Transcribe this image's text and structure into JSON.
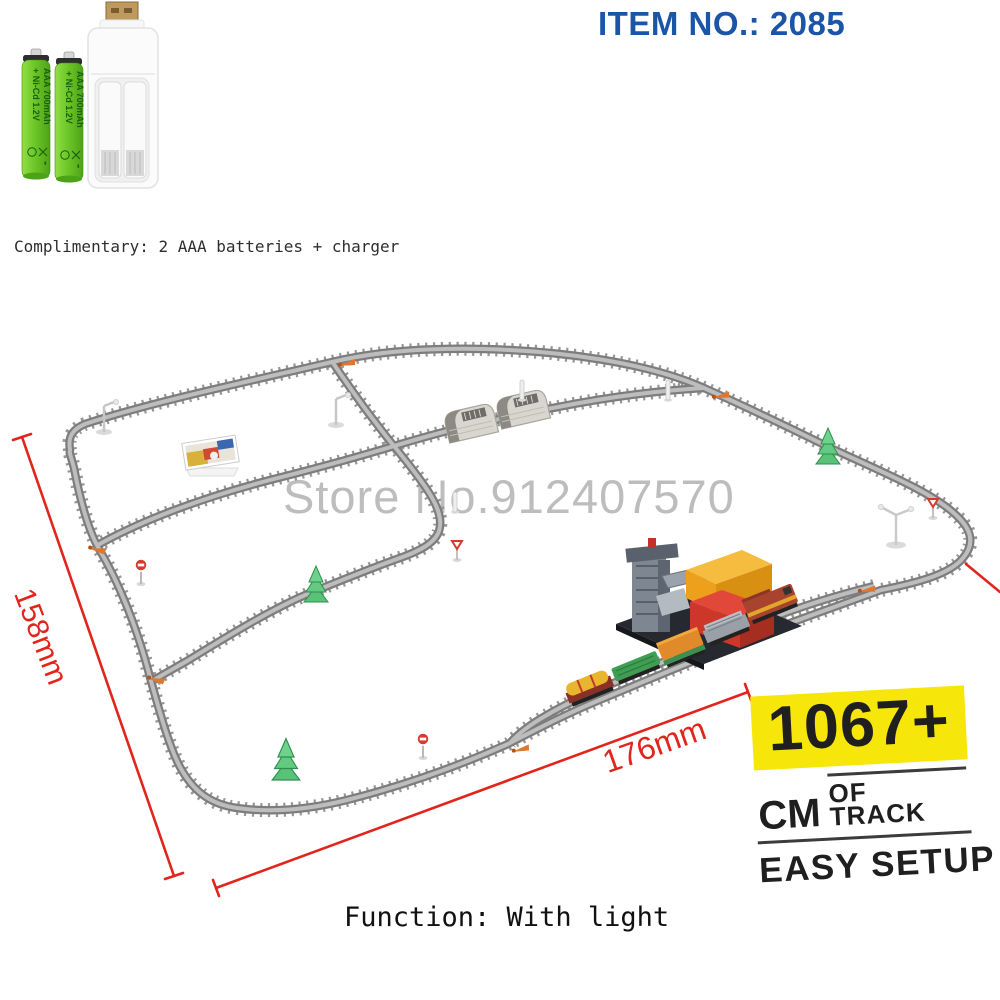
{
  "item_header": {
    "label": "ITEM NO.: 2085"
  },
  "complimentary_note": {
    "text": "Complimentary: 2 AAA batteries + charger"
  },
  "battery_labels": {
    "line1": "+ Ni-Cd 1.2V",
    "line2": "AAA 700mAh",
    "polarity_minus": "-"
  },
  "watermark": {
    "text": "Store No.912407570"
  },
  "dimensions": {
    "left_label": "158mm",
    "bottom_label": "176mm"
  },
  "badge": {
    "big": "1067+",
    "mid_big": "CM",
    "mid_small": "OF TRACK",
    "bottom": "EASY SETUP"
  },
  "function_note": {
    "text": "Function: With light"
  },
  "colors": {
    "item_no_blue": "#1b55a8",
    "dimension_red": "#e1251d",
    "badge_yellow": "#f6e60a",
    "track_gray": "#7d7d7d",
    "battery_green": "#6cc728",
    "watermark_gray": "#bdbdbd"
  },
  "scene": {
    "items": [
      {
        "name": "tunnel",
        "count": 2
      },
      {
        "name": "loading-station",
        "count": 1
      },
      {
        "name": "freight-train-car",
        "count": 5
      },
      {
        "name": "pine-tree",
        "count": 3
      },
      {
        "name": "lamp-post",
        "count": 3
      },
      {
        "name": "stop-sign",
        "count": 2
      },
      {
        "name": "yield-sign",
        "count": 2
      },
      {
        "name": "signal-post",
        "count": 3
      },
      {
        "name": "switch-lever",
        "count": 6
      },
      {
        "name": "billboard",
        "count": 1
      }
    ]
  }
}
